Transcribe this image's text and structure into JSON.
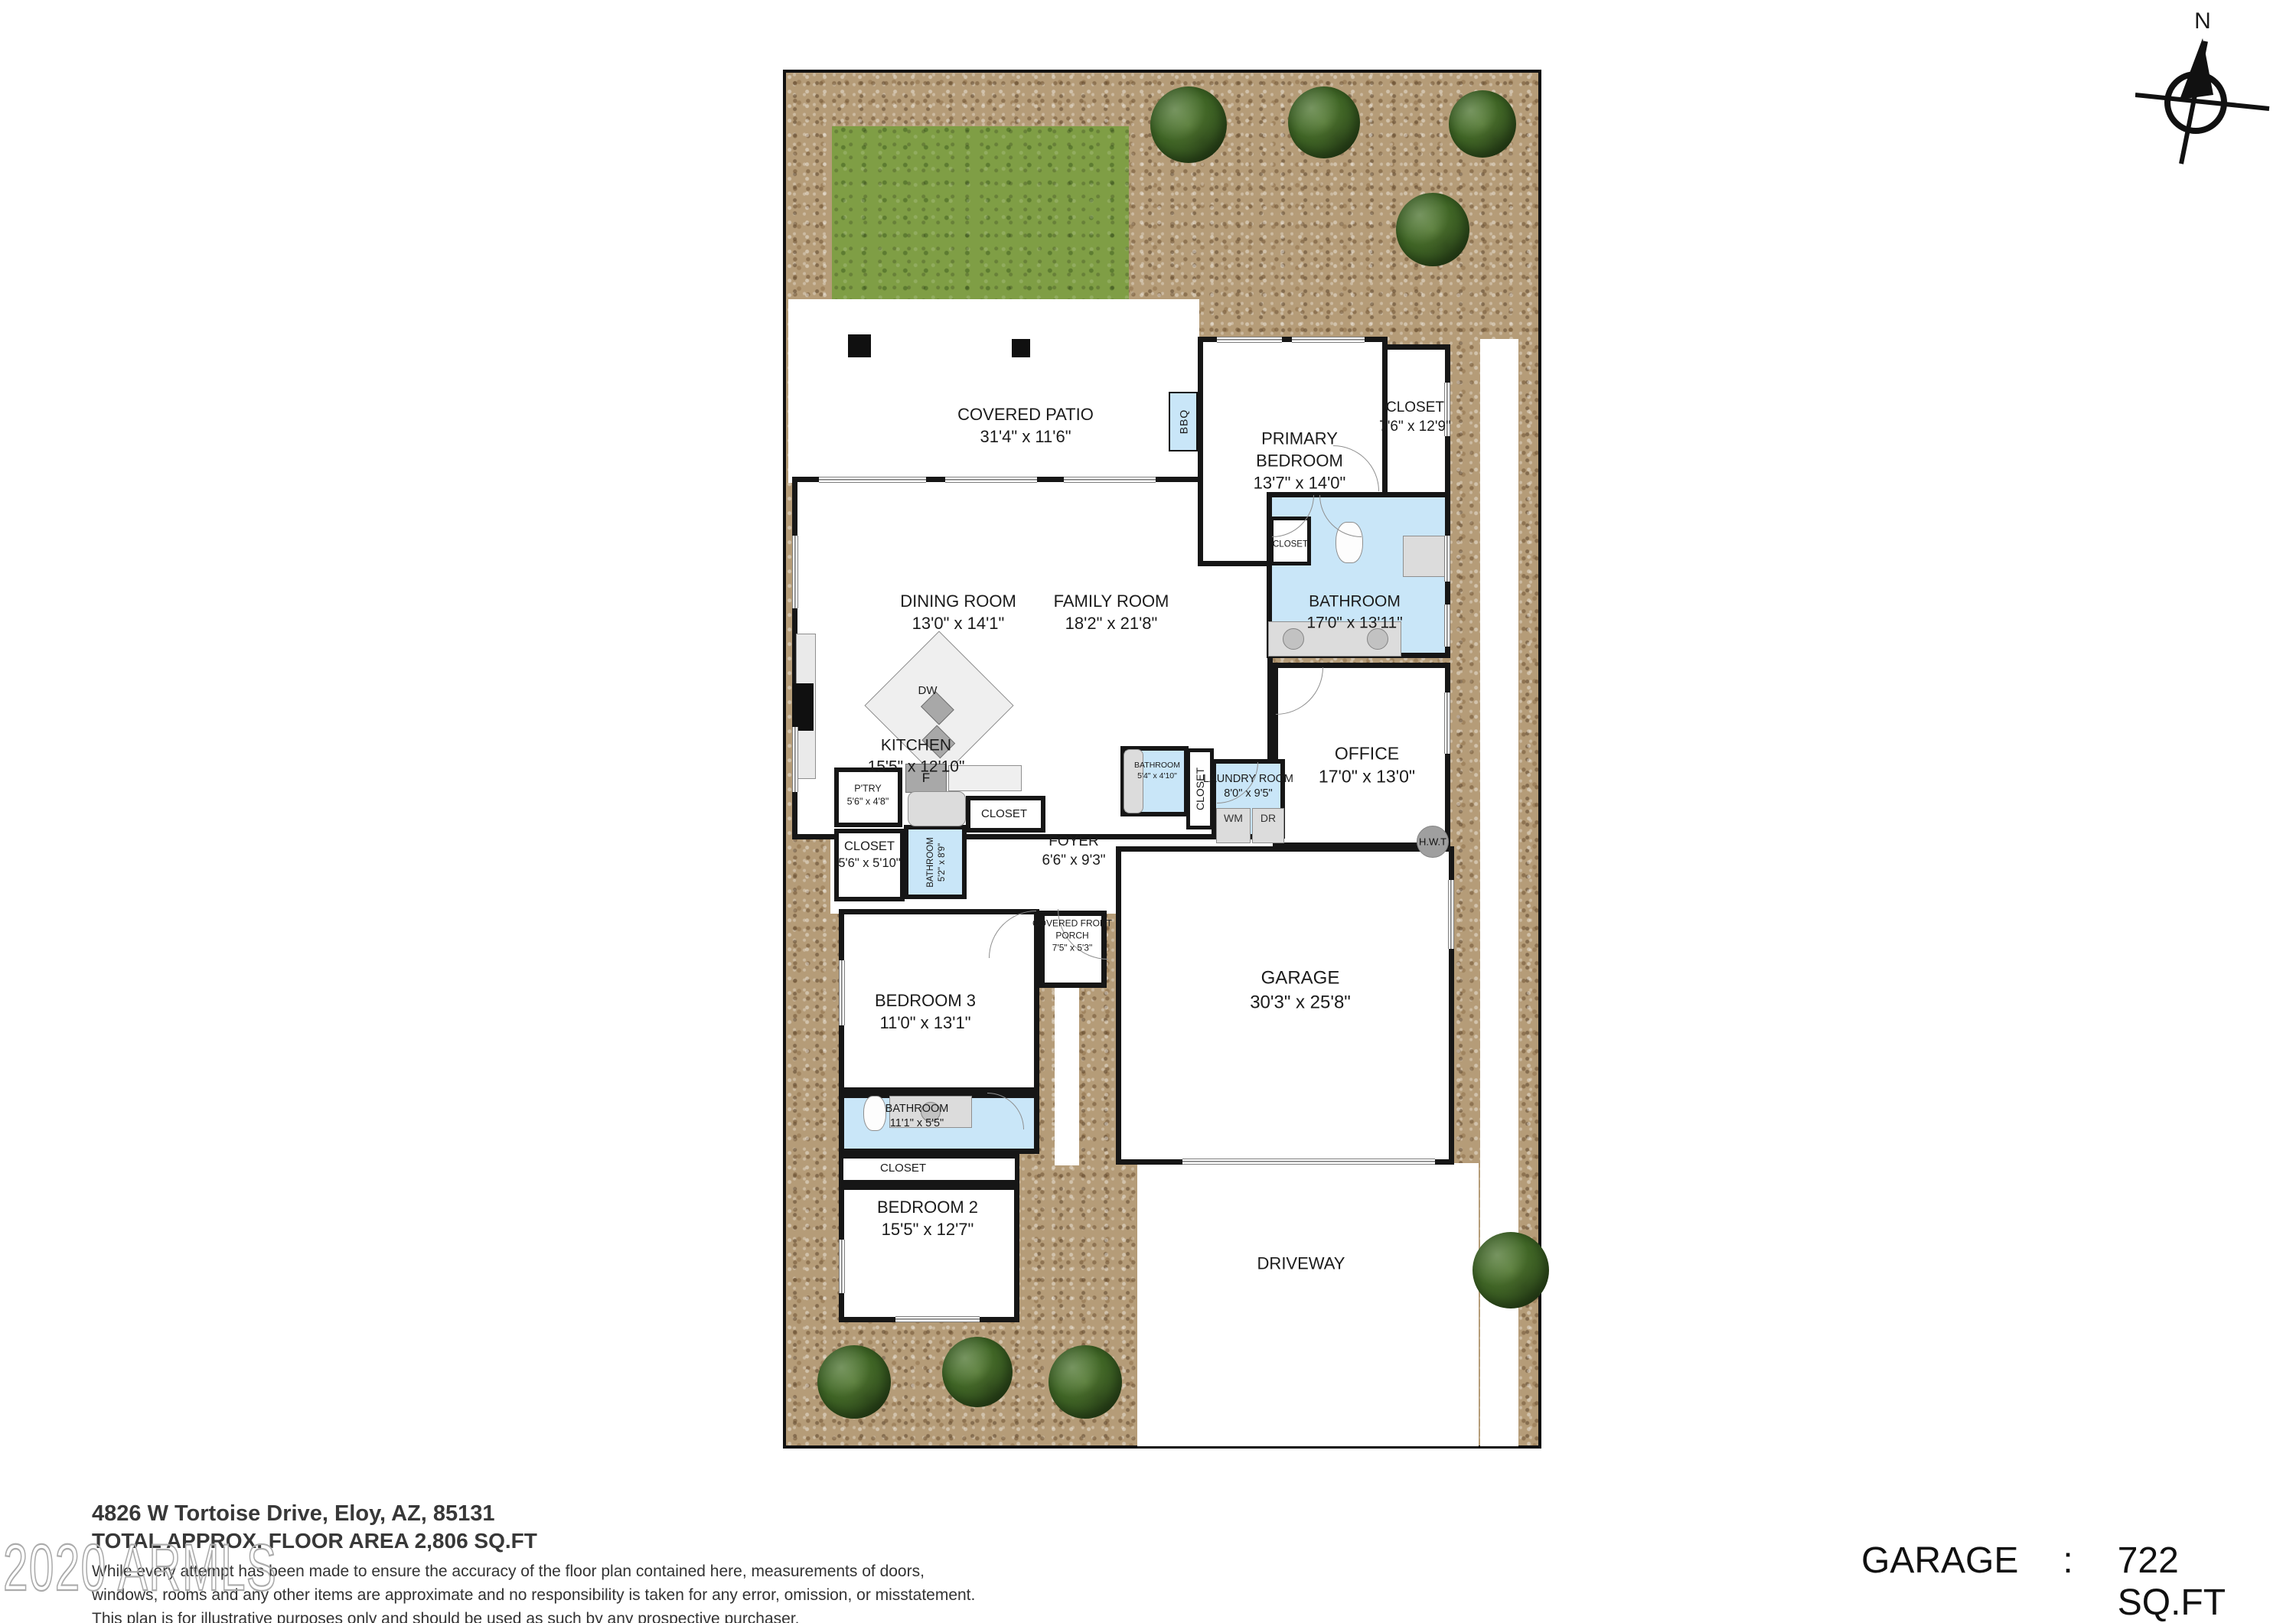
{
  "compass": {
    "n": "N"
  },
  "rooms": {
    "covered_patio": {
      "name": "COVERED PATIO",
      "dims": "31'4\" x 11'6\""
    },
    "primary_bedroom": {
      "name": "PRIMARY BEDROOM",
      "dims": "13'7\" x 14'0\""
    },
    "primary_closet": {
      "name": "CLOSET",
      "dims": "7'6\" x 12'9\""
    },
    "primary_bathroom": {
      "name": "BATHROOM",
      "dims": "17'0\" x 13'11\""
    },
    "primary_bath_closet": {
      "name": "CLOSET"
    },
    "dining_room": {
      "name": "DINING ROOM",
      "dims": "13'0\" x 14'1\""
    },
    "family_room": {
      "name": "FAMILY ROOM",
      "dims": "18'2\" x 21'8\""
    },
    "kitchen": {
      "name": "KITCHEN",
      "dims": "15'5\" x 12'10\""
    },
    "office": {
      "name": "OFFICE",
      "dims": "17'0\" x 13'0\""
    },
    "laundry_room": {
      "name": "LAUNDRY ROOM",
      "dims": "8'0\" x 9'5\""
    },
    "hall_closet": {
      "name": "CLOSET"
    },
    "small_bathroom": {
      "name": "BATHROOM",
      "dims": "5'4\" x 4'10\""
    },
    "pantry": {
      "name": "P'TRY",
      "dims": "5'6\" x 4'8\""
    },
    "foyer": {
      "name": "FOYER",
      "dims": "6'6\" x 9'3\""
    },
    "foyer_closet": {
      "name": "CLOSET"
    },
    "hall_bathroom": {
      "name": "BATHROOM",
      "dims": "5'2\" x 8'9\""
    },
    "main_closet": {
      "name": "CLOSET",
      "dims": "5'6\" x 5'10\""
    },
    "front_porch": {
      "name": "COVERED FRONT PORCH",
      "dims": "7'5\" x 5'3\""
    },
    "garage": {
      "name": "GARAGE",
      "dims": "30'3\" x 25'8\""
    },
    "bedroom3": {
      "name": "BEDROOM 3",
      "dims": "11'0\" x 13'1\""
    },
    "bathroom2": {
      "name": "BATHROOM",
      "dims": "11'1\" x 5'5\""
    },
    "closet2": {
      "name": "CLOSET"
    },
    "bedroom2": {
      "name": "BEDROOM 2",
      "dims": "15'5\" x 12'7\""
    },
    "driveway": {
      "name": "DRIVEWAY"
    }
  },
  "fixtures": {
    "bbq": "BBQ",
    "dw": "DW",
    "fridge": "F",
    "wm": "WM",
    "dr": "DR",
    "hwt": "H.W.T"
  },
  "footer": {
    "address": "4826 W Tortoise Drive, Eloy, AZ, 85131",
    "total": "TOTAL APPROX. FLOOR AREA 2,806 SQ.FT",
    "disc1": "While every attempt has been made to ensure the accuracy of the floor plan contained here, measurements of doors,",
    "disc2": "windows, rooms and any other items are approximate and no responsibility is taken for any error, omission, or misstatement.",
    "disc3": "This plan is for illustrative purposes only and should be used as such by any prospective purchaser."
  },
  "watermark": "2020 ARMLS",
  "callout": {
    "label": "GARAGE",
    "colon": ":",
    "value": "722 SQ.FT"
  }
}
